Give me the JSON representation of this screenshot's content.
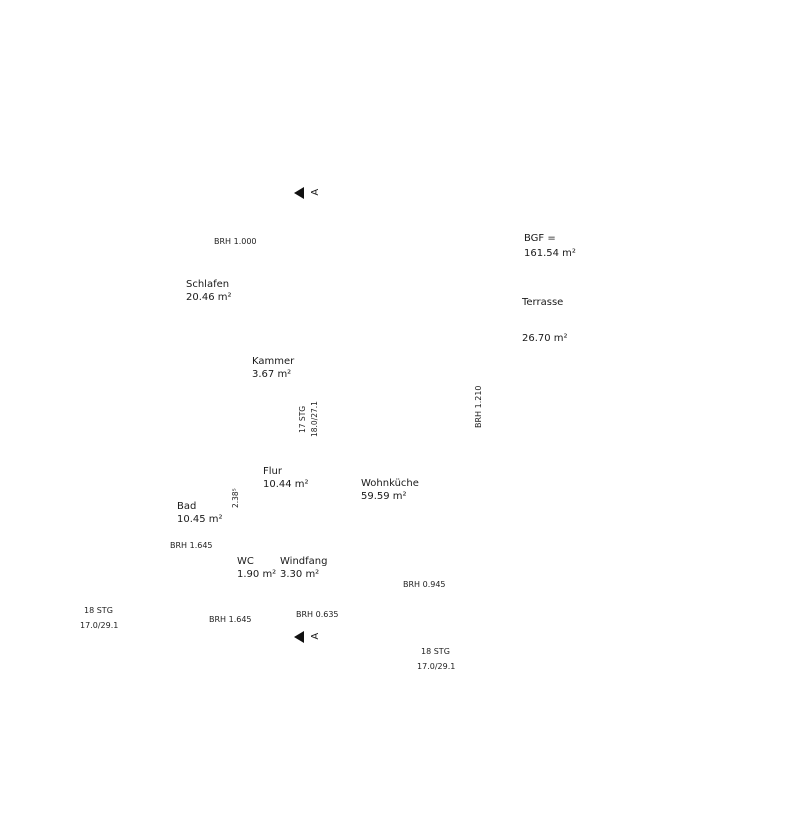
{
  "rooms": [
    {
      "id": "schlafen",
      "name": "Schlafen",
      "area": "20.46 m²"
    },
    {
      "id": "kammer",
      "name": "Kammer",
      "area": "3.67 m²"
    },
    {
      "id": "flur",
      "name": "Flur",
      "area": "10.44 m²"
    },
    {
      "id": "bad",
      "name": "Bad",
      "area": "10.45 m²"
    },
    {
      "id": "wc",
      "name": "WC",
      "area": "1.90 m²"
    },
    {
      "id": "windfang",
      "name": "Windfang",
      "area": "3.30 m²"
    },
    {
      "id": "wohnkueche",
      "name": "Wohnküche",
      "area": "59.59 m²"
    },
    {
      "id": "terrasse",
      "name": "Terrasse",
      "area": "26.70 m²"
    }
  ],
  "bgf": {
    "label": "BGF =",
    "value": "161.54 m²"
  },
  "brh": [
    {
      "id": "brh-top",
      "text": "BRH 1.000"
    },
    {
      "id": "brh-right",
      "text": "BRH 1.210"
    },
    {
      "id": "brh-kitchen",
      "text": "BRH 0.945"
    },
    {
      "id": "brh-bad",
      "text": "BRH 1.645"
    },
    {
      "id": "brh-bottom",
      "text": "BRH 1.645"
    },
    {
      "id": "brh-porch",
      "text": "BRH 0.635"
    }
  ],
  "stairs": {
    "interior": [
      "17 STG",
      "18.0/27.1"
    ],
    "exterior_bottom": [
      "18 STG",
      "17.0/29.1"
    ],
    "exterior_left": [
      "18 STG",
      "17.0/29.1"
    ]
  },
  "section": {
    "letter": "A"
  },
  "extra_dims": [
    {
      "id": "i2",
      "text": "2.38⁵"
    }
  ],
  "dims": {
    "top": [
      {
        "id": "t1",
        "segs": [
          {
            "l": "13.61⁵",
            "v": 13.615
          }
        ]
      },
      {
        "id": "t2",
        "segs": [
          {
            "l": "11.36⁵",
            "v": 11.365
          },
          {
            "l": "2.25",
            "v": 2.25
          }
        ]
      },
      {
        "id": "t3",
        "segs": [
          {
            "l": "36⁵",
            "v": 0.365
          },
          {
            "l": "2.26",
            "v": 2.26
          },
          {
            "l": "11⁵",
            "v": 0.115
          },
          {
            "l": "2.01",
            "v": 2.01
          },
          {
            "l": "11⁵",
            "v": 0.115
          },
          {
            "l": "1.01",
            "v": 1.01
          },
          {
            "l": "11⁵",
            "v": 0.115
          },
          {
            "l": "5.01",
            "v": 5.01
          },
          {
            "l": "36⁵",
            "v": 0.365
          },
          {
            "l": "2.25",
            "v": 2.25
          }
        ]
      },
      {
        "id": "t4",
        "segs": [
          {
            "l": "36⁵",
            "v": 0.365
          },
          {
            "l": "4.38⁵",
            "v": 4.385
          },
          {
            "l": "11⁵",
            "v": 0.115
          },
          {
            "l": "6.13⁵",
            "v": 6.135
          },
          {
            "l": "36⁵",
            "v": 0.365
          },
          {
            "l": "2.25",
            "v": 2.25
          }
        ]
      },
      {
        "id": "t5",
        "segs": [
          {
            "l": "1.99",
            "v": 1.99
          },
          {
            "l": "2.01",
            "v": 2.01,
            "sub": "1.39⁵",
            "sb": true
          },
          {
            "l": "7.36⁵",
            "v": 7.365
          },
          {
            "l": "2.25",
            "v": 2.25
          }
        ]
      }
    ],
    "bottom": [
      {
        "id": "b1",
        "segs": [
          {
            "l": "61⁵",
            "v": 0.615
          },
          {
            "l": "1.51",
            "v": 1.51
          },
          {
            "l": "61⁵",
            "v": 0.615
          },
          {
            "l": "76",
            "v": 0.76
          },
          {
            "l": "61⁵",
            "v": 0.615
          },
          {
            "l": "1.13⁵",
            "v": 1.135
          },
          {
            "l": "50",
            "v": 0.5
          },
          {
            "l": "1.74",
            "v": 1.74
          },
          {
            "l": "2.26",
            "v": 2.26
          },
          {
            "l": "1.61⁵",
            "v": 1.615
          },
          {
            "l": "2.25",
            "v": 2.25
          }
        ]
      },
      {
        "id": "b2",
        "segs": [
          {
            "l": "36⁵",
            "v": 0.365
          },
          {
            "l": "2.01",
            "v": 2.01,
            "sub": "75"
          },
          {
            "l": "11⁵",
            "v": 0.115
          },
          {
            "l": "1.26",
            "v": 1.26,
            "sub": "75"
          },
          {
            "l": "11⁵",
            "v": 0.115
          },
          {
            "l": "2.18⁵",
            "v": 2.185,
            "sub": "2.57⁵  1.70"
          },
          {
            "l": "11⁵",
            "v": 0.115
          },
          {
            "l": "4.83⁵",
            "v": 4.835,
            "sub": "75"
          },
          {
            "l": "36⁵",
            "v": 0.365
          },
          {
            "l": "2.25",
            "v": 2.25
          }
        ]
      },
      {
        "id": "b3",
        "segs": [
          {
            "l": "36⁵",
            "v": 0.365
          },
          {
            "l": "3.01",
            "v": 3.01
          },
          {
            "l": "11⁵",
            "v": 0.115
          },
          {
            "l": "1.26",
            "v": 1.26
          },
          {
            "l": "11⁵",
            "v": 0.115
          },
          {
            "l": "1.01",
            "v": 1.01
          },
          {
            "l": "11⁵",
            "v": 0.115
          },
          {
            "l": "5.01",
            "v": 5.01
          },
          {
            "l": "36⁵",
            "v": 0.365
          },
          {
            "l": "2.25",
            "v": 2.25
          }
        ]
      },
      {
        "id": "b4",
        "segs": [
          {
            "l": "11.36⁵",
            "v": 11.365
          },
          {
            "l": "2.25",
            "v": 2.25
          }
        ]
      },
      {
        "id": "b5",
        "segs": [
          {
            "l": "13.61⁵",
            "v": 13.615
          }
        ]
      }
    ],
    "left": [
      {
        "id": "l1",
        "segs": [
          {
            "l": "11.86⁵",
            "v": 11.865
          },
          {
            "l": "2.26",
            "v": 2.26
          },
          {
            "l": "12⁵",
            "v": 0.125
          }
        ]
      },
      {
        "id": "l2",
        "segs": [
          {
            "l": "36⁵",
            "v": 0.365
          },
          {
            "l": "3.63⁵",
            "v": 3.635
          },
          {
            "l": "17⁵",
            "v": 0.175
          },
          {
            "l": "1.82⁵",
            "v": 1.825
          },
          {
            "l": "11⁵",
            "v": 0.115
          },
          {
            "l": "1.26",
            "v": 1.26
          },
          {
            "l": "11⁵",
            "v": 0.115
          },
          {
            "l": "4.01",
            "v": 4.01
          },
          {
            "l": "36⁵",
            "v": 0.365
          },
          {
            "l": "1.00",
            "v": 1.0
          },
          {
            "l": "1.26",
            "v": 1.26
          }
        ]
      }
    ],
    "right": [
      {
        "id": "r1",
        "segs": [
          {
            "l": "1.24",
            "v": 1.24
          },
          {
            "l": "2.51",
            "v": 2.51
          },
          {
            "l": "92⁵",
            "v": 0.925
          },
          {
            "l": "2.51",
            "v": 2.51
          },
          {
            "l": "93",
            "v": 0.93
          },
          {
            "l": "2.51",
            "v": 2.51
          },
          {
            "l": "1.24",
            "v": 1.24
          },
          {
            "l": "1.26",
            "v": 1.26
          },
          {
            "l": "1.00",
            "v": 1.0
          },
          {
            "l": "12⁵",
            "v": 0.125
          }
        ]
      },
      {
        "id": "r2",
        "segs": [
          {
            "l": "36⁵",
            "v": 0.365
          },
          {
            "l": "3.63⁵",
            "v": 3.635,
            "sub": "2.57⁵"
          },
          {
            "l": "17⁵",
            "v": 0.175
          },
          {
            "l": "3.39",
            "v": 3.39,
            "sub": "1.36⁵"
          },
          {
            "l": "30",
            "v": 0.3
          },
          {
            "l": "2.01",
            "v": 2.01,
            "sub": "1⁵ 57⁵"
          },
          {
            "l": "11⁵",
            "v": 0.115
          },
          {
            "l": "1.51",
            "v": 1.51
          },
          {
            "l": "36⁵",
            "v": 0.365
          },
          {
            "l": "2.26",
            "v": 2.26
          },
          {
            "l": "12⁵",
            "v": 0.125
          }
        ]
      },
      {
        "id": "r3",
        "segs": [
          {
            "l": "36⁵",
            "v": 0.365
          },
          {
            "l": "3.63⁵",
            "v": 3.635
          },
          {
            "l": "17⁵",
            "v": 0.175
          },
          {
            "l": "4.28",
            "v": 4.28
          },
          {
            "l": "1.42",
            "v": 1.42
          },
          {
            "l": "11⁵",
            "v": 0.115
          },
          {
            "l": "1.51",
            "v": 1.51
          },
          {
            "l": "36⁵",
            "v": 0.365
          },
          {
            "l": "2.26",
            "v": 2.26
          }
        ]
      },
      {
        "id": "r4",
        "segs": [
          {
            "l": "36⁵",
            "v": 0.365
          },
          {
            "l": "3.63⁵",
            "v": 3.635
          },
          {
            "l": "17⁵",
            "v": 0.175
          },
          {
            "l": "1.82⁵",
            "v": 1.825
          },
          {
            "l": "11⁵",
            "v": 0.115
          },
          {
            "l": "3.76",
            "v": 3.76
          },
          {
            "l": "11⁵",
            "v": 0.115
          },
          {
            "l": "1.51",
            "v": 1.51
          },
          {
            "l": "36⁵",
            "v": 0.365
          }
        ]
      },
      {
        "id": "r5",
        "segs": [
          {
            "l": "11.86⁵",
            "v": 11.865
          }
        ]
      }
    ],
    "interior": [
      {
        "id": "i1",
        "segs": [
          {
            "l": "60",
            "v": 0.6
          },
          {
            "l": "1.66",
            "v": 1.66
          },
          {
            "l": "11⁵",
            "v": 0.115
          },
          {
            "l": "62",
            "v": 0.62
          },
          {
            "l": "76",
            "v": 0.76
          },
          {
            "l": "63",
            "v": 0.63
          }
        ]
      }
    ]
  }
}
